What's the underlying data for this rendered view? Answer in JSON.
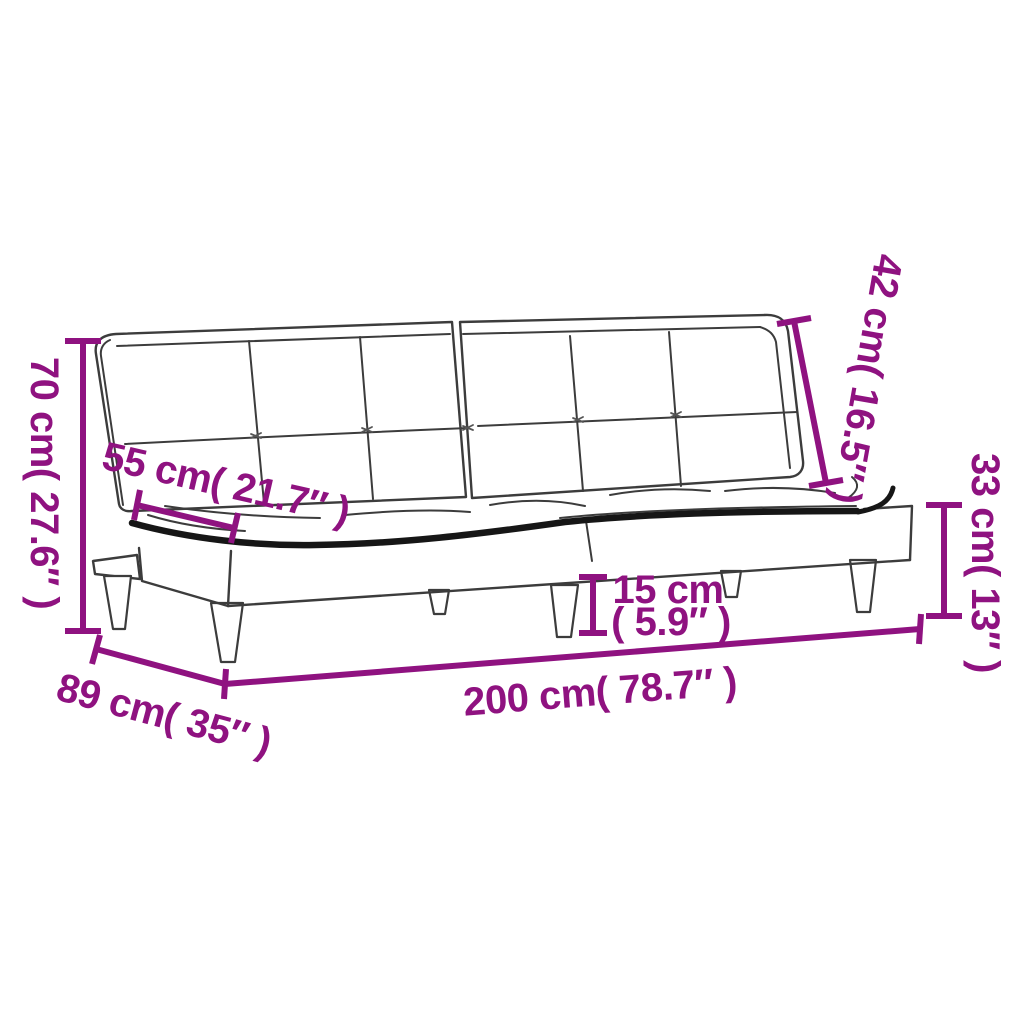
{
  "diagram": {
    "type": "product-dimension-diagram",
    "subject": "sofa-bed-line-drawing",
    "background": "#ffffff"
  },
  "colors": {
    "dimension_accent": "#8F1280",
    "drawing_line": "#3c3c3c",
    "drawing_bold": "#161616"
  },
  "labels": {
    "overall_height": "70 cm( 27.6″ )",
    "seat_depth": "55 cm( 21.7″ )",
    "backrest_height": "42 cm( 16.5″ )",
    "seat_height": "33 cm( 13″ )",
    "clearance_cm": "15 cm",
    "clearance_in": "( 5.9″ )",
    "overall_depth": "89 cm( 35″ )",
    "overall_width": "200 cm( 78.7″ )"
  }
}
